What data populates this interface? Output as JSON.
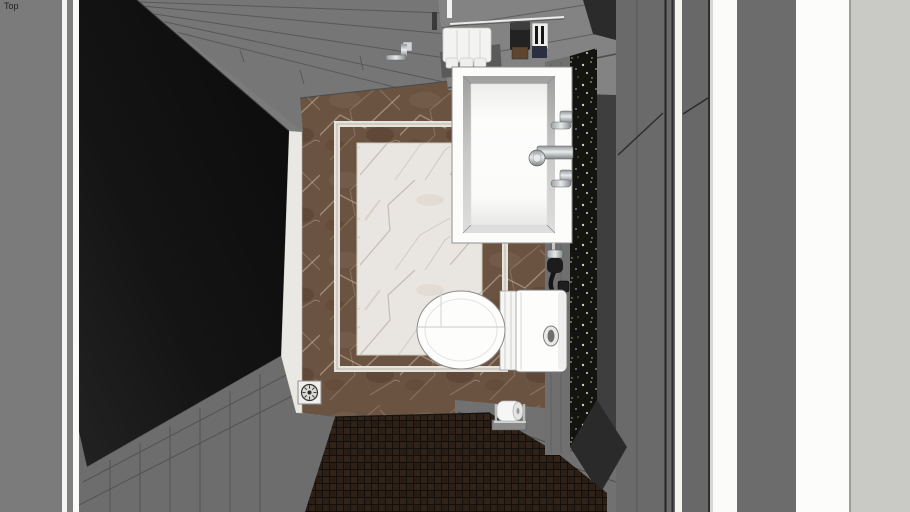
{
  "viewport": {
    "view_label": "Top",
    "background_color": "#7b7b7b"
  },
  "scene": {
    "type": "bathroom-top-down-3d-view",
    "objects": [
      {
        "name": "shower-glass-panel",
        "color": "#121212"
      },
      {
        "name": "wall-planks-north",
        "color": "#767676"
      },
      {
        "name": "wall-planks-southwest",
        "color": "#6d6d6d"
      },
      {
        "name": "marble-floor-border",
        "color": "#6b5342"
      },
      {
        "name": "marble-floor-center",
        "color": "#e9e6e1"
      },
      {
        "name": "marble-inlay-frame",
        "color": "#e6e3dc"
      },
      {
        "name": "marble-threshold",
        "color": "#eae8e3"
      },
      {
        "name": "mosaic-floor",
        "color": "#2b1e16"
      },
      {
        "name": "granite-strip",
        "color": "#131310"
      },
      {
        "name": "section-cut-wall-stripes",
        "color": "#f5f5f3"
      },
      {
        "name": "vanity-counter",
        "color": "#838383"
      },
      {
        "name": "sink-basin",
        "color": "#fcfcfb"
      },
      {
        "name": "faucet",
        "color": "#b9bcbe"
      },
      {
        "name": "towels",
        "color": "#f3f3f1"
      },
      {
        "name": "wall-hook",
        "color": "#c9ccce"
      },
      {
        "name": "soap-dispenser-box",
        "color": "#222222"
      },
      {
        "name": "striped-tumbler",
        "color": "#ededeb"
      },
      {
        "name": "hand-sprayer",
        "color": "#1c1c1c"
      },
      {
        "name": "toilet",
        "color": "#fdfdfc"
      },
      {
        "name": "toilet-flush-button",
        "color": "#8f8f8f"
      },
      {
        "name": "toilet-paper-holder",
        "color": "#f6f6f4"
      },
      {
        "name": "floor-drain",
        "color": "#f0efeb"
      }
    ]
  }
}
